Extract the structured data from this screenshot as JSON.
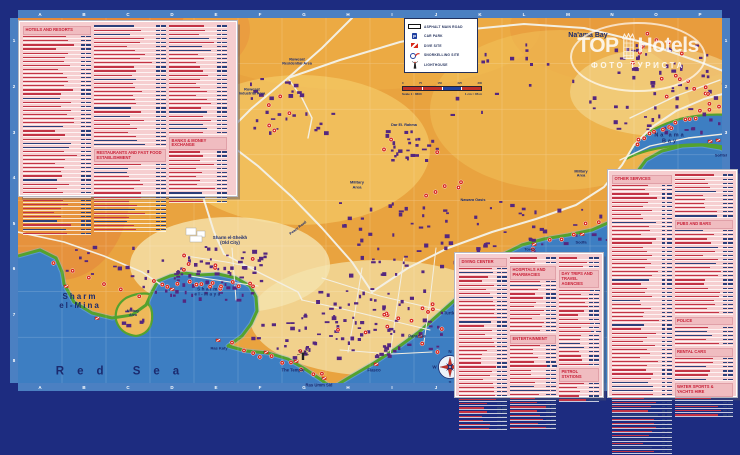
{
  "watermark": {
    "top": "TOP",
    "hotels": "Hotels",
    "subtitle": "ФОТО ТУРИСТА"
  },
  "legend": {
    "items": [
      {
        "label": "ASPHALT MAIN ROAD",
        "icon": "road"
      },
      {
        "label": "CAR PARK",
        "icon": "car-park",
        "icon_char": "P"
      },
      {
        "label": "DIVE SITE",
        "icon": "dive-flag"
      },
      {
        "label": "SNORKELLING SITE",
        "icon": "snorkel"
      },
      {
        "label": "LIGHTHOUSE",
        "icon": "lighthouse"
      }
    ],
    "scale_ticks": [
      "0",
      "75",
      "150",
      "225",
      "300"
    ],
    "scale_text_left": "Scale 1 : 8600",
    "scale_text_right": "1 cm = 86 m"
  },
  "panels": {
    "hotels": {
      "title": "HOTELS AND RESORTS"
    },
    "restaurants": {
      "title": "RESTAURANTS AND FAST FOOD ESTABLISHMENT"
    },
    "banks": {
      "title": "BANKS & MONEY EXCHANGE"
    },
    "other_services": {
      "title": "OTHER SERVICES"
    },
    "pubs": {
      "title": "PUBS AND BARS"
    },
    "police": {
      "title": "POLICE"
    },
    "rental": {
      "title": "RENTAL CARS"
    },
    "water_sports": {
      "title": "WATER SPORTS & YACHTS HIRE"
    },
    "diving": {
      "title": "DIVING CENTER"
    },
    "hospitals": {
      "title": "HOSPITALS AND PHARMACIES"
    },
    "entertainment": {
      "title": "ENTERTAINMENT"
    },
    "day_trips": {
      "title": "DAY TRIPS AND TRAVEL AGENCIES"
    },
    "petrol": {
      "title": "PETROL STATIONS"
    }
  },
  "map": {
    "labels": [
      {
        "t": "Na'ama Bay",
        "x": 588,
        "y": 36,
        "s": 7
      },
      {
        "t": "Rowesat\nResidential Area",
        "x": 297,
        "y": 62,
        "s": 3.8
      },
      {
        "t": "Rowesat\nIndustrial Area",
        "x": 252,
        "y": 92,
        "s": 3.8
      },
      {
        "t": "Dar El. Rahma",
        "x": 404,
        "y": 125,
        "s": 3.8
      },
      {
        "t": "Na'ama\nBay",
        "x": 670,
        "y": 139,
        "s": 5.5,
        "ls": 2
      },
      {
        "t": "Sofitel",
        "x": 721,
        "y": 156,
        "s": 4
      },
      {
        "t": "Military\nArea",
        "x": 581,
        "y": 174,
        "s": 3.8
      },
      {
        "t": "Military\nArea",
        "x": 357,
        "y": 185,
        "s": 4
      },
      {
        "t": "Nawara Oasis",
        "x": 473,
        "y": 200,
        "s": 3.8
      },
      {
        "t": "Sharm el-Sheikh\n(Old City)",
        "x": 230,
        "y": 240,
        "s": 4.4
      },
      {
        "t": "Peace Road",
        "x": 298,
        "y": 228,
        "s": 3.6,
        "r": -38
      },
      {
        "t": "Pinkie's Wall",
        "x": 492,
        "y": 267,
        "s": 4
      },
      {
        "t": "Tower",
        "x": 530,
        "y": 250,
        "s": 4
      },
      {
        "t": "Sodfa",
        "x": 581,
        "y": 243,
        "s": 4
      },
      {
        "t": "Turtle Bay",
        "x": 454,
        "y": 314,
        "s": 4.2
      },
      {
        "t": "Paradise",
        "x": 417,
        "y": 337,
        "s": 4.2
      },
      {
        "t": "Fiasco",
        "x": 374,
        "y": 371,
        "s": 4.2
      },
      {
        "t": "The Temple",
        "x": 293,
        "y": 371,
        "s": 4.2
      },
      {
        "t": "Ras Umm Sid",
        "x": 319,
        "y": 386,
        "s": 4.2
      },
      {
        "t": "Ras Katy",
        "x": 219,
        "y": 349,
        "s": 4
      },
      {
        "t": "Military\nArea",
        "x": 133,
        "y": 313,
        "s": 3.5
      },
      {
        "t": "Sharm\nel-Mina",
        "x": 80,
        "y": 301,
        "s": 8,
        "ls": 2
      },
      {
        "t": "Sharm\nel-Maya",
        "x": 208,
        "y": 292,
        "s": 4.6,
        "ls": 1.5
      },
      {
        "t": "Red Sea",
        "x": 124,
        "y": 372,
        "s": 11.5,
        "ls": 13
      }
    ],
    "dive_sites": [
      [
        64,
        288
      ],
      [
        95,
        320
      ],
      [
        170,
        291
      ],
      [
        216,
        342
      ],
      [
        264,
        354
      ],
      [
        294,
        363
      ],
      [
        322,
        380
      ],
      [
        374,
        366
      ],
      [
        418,
        338
      ],
      [
        454,
        307
      ],
      [
        498,
        262
      ],
      [
        532,
        246
      ],
      [
        580,
        236
      ],
      [
        708,
        143
      ],
      [
        716,
        142
      ]
    ],
    "compass": [
      "N",
      "E",
      "S",
      "W"
    ],
    "grid_cols": [
      "A",
      "B",
      "C",
      "D",
      "E",
      "F",
      "G",
      "H",
      "I",
      "J",
      "K",
      "L",
      "M",
      "N",
      "O",
      "P"
    ],
    "grid_rows": [
      "1",
      "2",
      "3",
      "4",
      "5",
      "6",
      "7",
      "8"
    ]
  },
  "colors": {
    "sea": "#3d7ec2",
    "sand": "#e9a33f",
    "coast_green": "#54a22e",
    "building_purple": "#55277f",
    "marker_red": "#d7271b",
    "panel_pink": "#f6ced0",
    "header_red": "#c81e35",
    "frame_blue": "#4b80c2",
    "border_navy": "#1d2c80"
  }
}
